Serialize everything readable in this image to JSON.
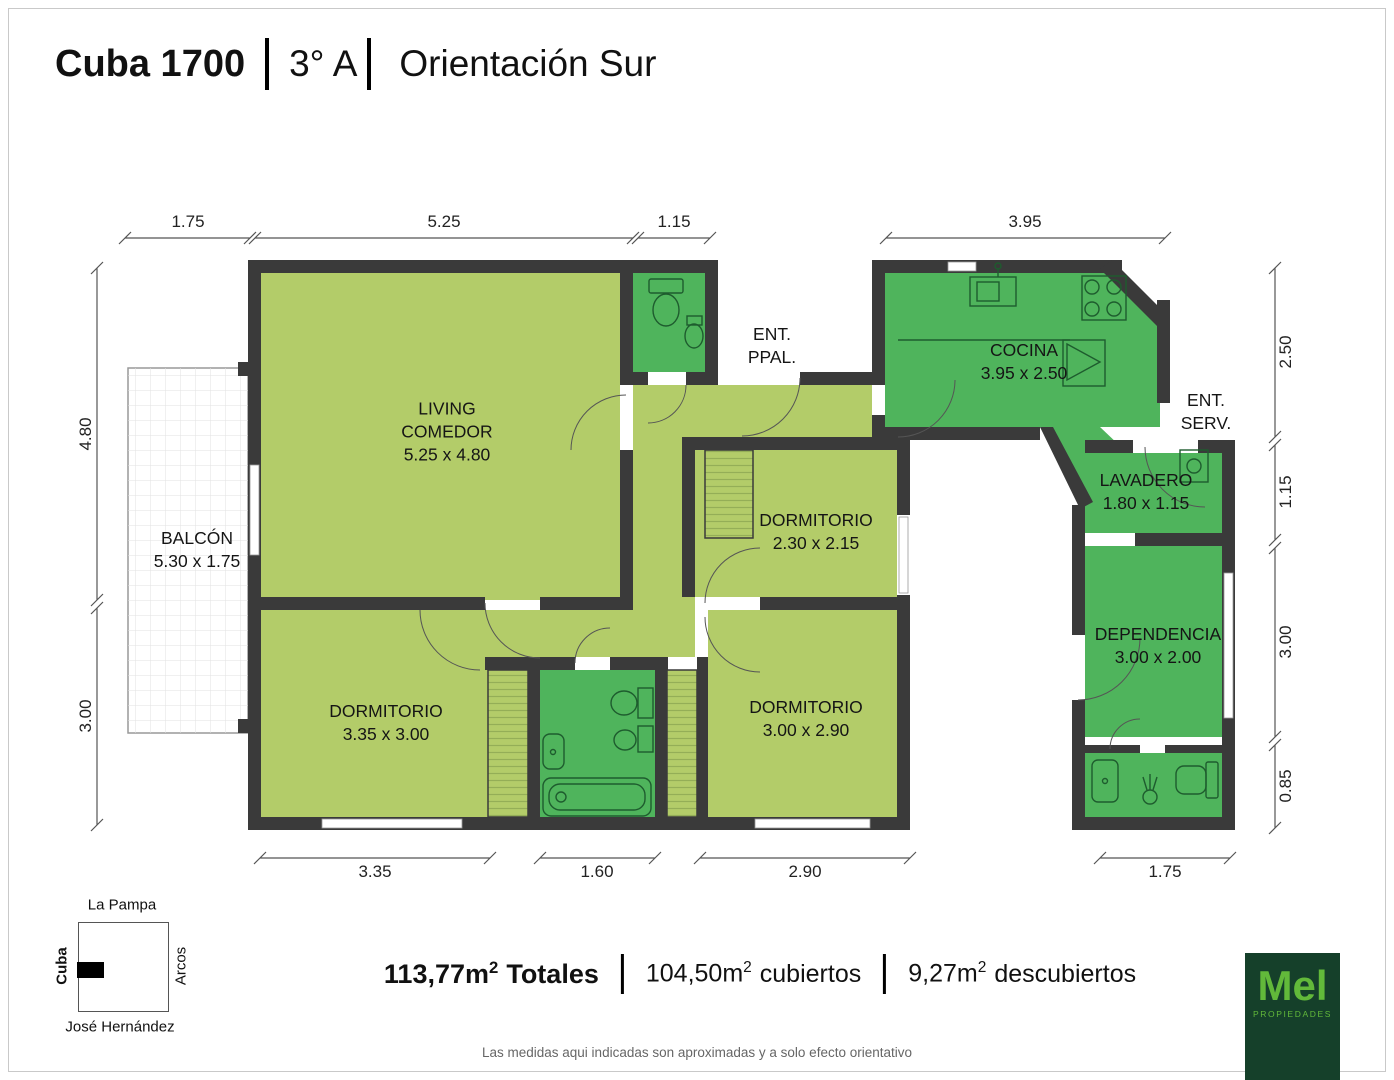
{
  "title": {
    "building": "Cuba 1700",
    "unit": "3° A",
    "orientation": "Orientación Sur"
  },
  "rooms": {
    "living": {
      "name": "LIVING COMEDOR",
      "size": "5.25 x 4.80"
    },
    "balcon": {
      "name": "BALCÓN",
      "size": "5.30 x 1.75"
    },
    "dorm_small": {
      "name": "DORMITORIO",
      "size": "2.30 x 2.15"
    },
    "dorm_left": {
      "name": "DORMITORIO",
      "size": "3.35 x 3.00"
    },
    "dorm_right": {
      "name": "DORMITORIO",
      "size": "3.00 x 2.90"
    },
    "cocina": {
      "name": "COCINA",
      "size": "3.95 x 2.50"
    },
    "lavadero": {
      "name": "LAVADERO",
      "size": "1.80 x 1.15"
    },
    "dependencia": {
      "name": "DEPENDENCIA",
      "size": "3.00 x 2.00"
    }
  },
  "entries": {
    "main_line1": "ENT.",
    "main_line2": "PPAL.",
    "service_line1": "ENT.",
    "service_line2": "SERV."
  },
  "dimensions": {
    "top": [
      "1.75",
      "5.25",
      "1.15",
      "3.95"
    ],
    "left": [
      "4.80",
      "3.00"
    ],
    "right": [
      "2.50",
      "1.15",
      "3.00",
      "0.85"
    ],
    "bottom": [
      "3.35",
      "1.60",
      "2.90",
      "1.75"
    ]
  },
  "minimap": {
    "north": "La Pampa",
    "west": "Cuba",
    "east": "Arcos",
    "south": "José Hernández"
  },
  "totals": {
    "segments": [
      {
        "value": "113,77m",
        "sup": "2",
        "label": "Totales"
      },
      {
        "value": "104,50m",
        "sup": "2",
        "label": "cubiertos"
      },
      {
        "value": "9,27m",
        "sup": "2",
        "label": "descubiertos"
      }
    ]
  },
  "disclaimer": "Las medidas aqui indicadas son aproximadas y a solo efecto orientativo",
  "logo": {
    "brand": "Mel",
    "tagline": "PROPIEDADES"
  },
  "colors": {
    "room_light": "#b3cc69",
    "room_green": "#4fb45c",
    "wall": "#3a3a3a",
    "logo_bg": "#15402a",
    "logo_text": "#62b93a"
  }
}
